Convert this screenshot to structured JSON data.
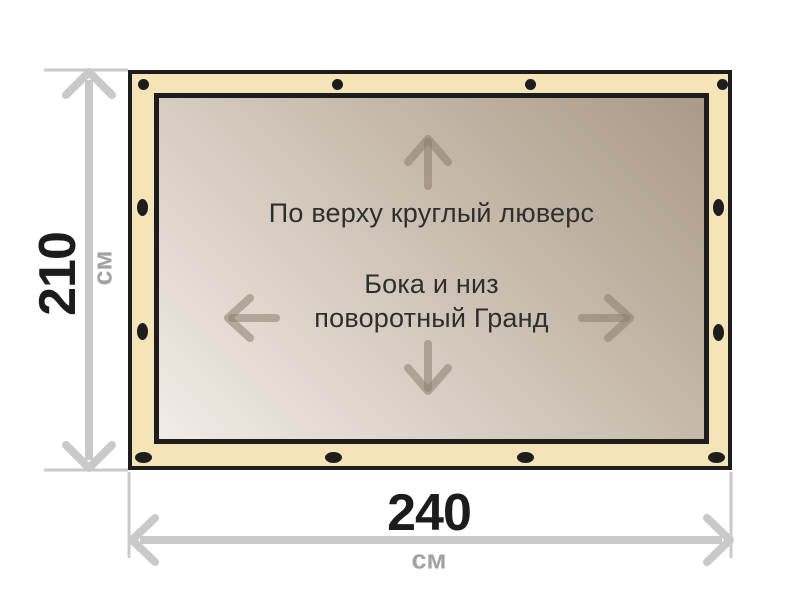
{
  "banner": {
    "top_note": "По верху круглый люверс",
    "center_note_line1": "Бока и низ",
    "center_note_line2": "поворотный Гранд",
    "fabric_color": "#f4e4b8",
    "outline_color": "#1d1d1d",
    "surface_gradient_light": "#f2ece6",
    "surface_gradient_dark": "#aa9985",
    "direction_arrow_color": "#8b7d6e",
    "grommets": {
      "color": "#1d1d1d",
      "top_round": [
        {
          "x": 143,
          "y": 84
        },
        {
          "x": 337,
          "y": 84
        },
        {
          "x": 530,
          "y": 84
        },
        {
          "x": 722,
          "y": 84
        }
      ],
      "bottom_oval": [
        {
          "x": 143,
          "y": 457
        },
        {
          "x": 333,
          "y": 457
        },
        {
          "x": 525,
          "y": 457
        },
        {
          "x": 716,
          "y": 457
        }
      ],
      "left_oval": [
        {
          "x": 142,
          "y": 207
        },
        {
          "x": 142,
          "y": 331
        }
      ],
      "right_oval": [
        {
          "x": 718,
          "y": 207
        },
        {
          "x": 718,
          "y": 332
        }
      ]
    }
  },
  "dimensions": {
    "height_value": "210",
    "height_unit": "см",
    "width_value": "240",
    "width_unit": "см",
    "line_color": "#c9c9c9",
    "value_color": "#1c1c1c",
    "unit_color": "#a2a2a2"
  },
  "page_background": "#ffffff"
}
